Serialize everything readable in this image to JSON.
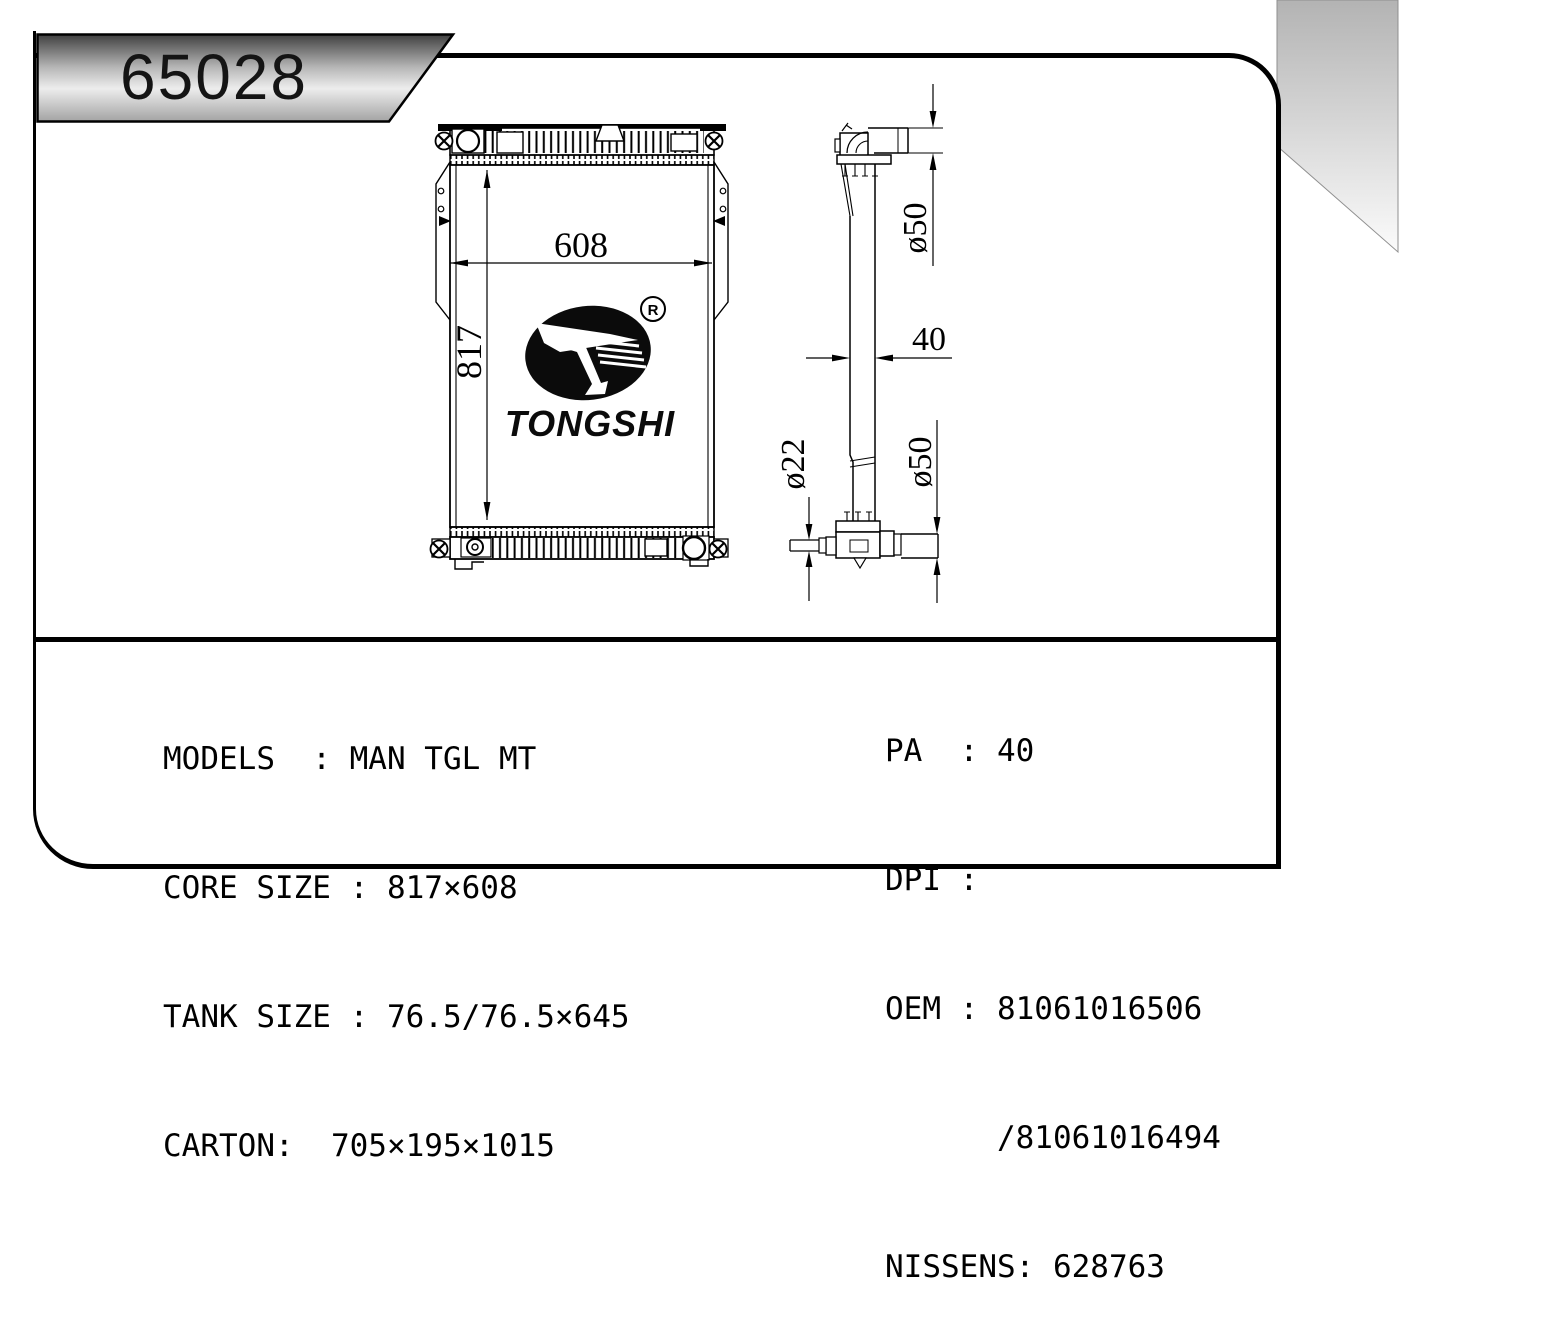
{
  "sheet": {
    "part_number": "65028"
  },
  "logo": {
    "wordmark": "TONGSHI",
    "registered_mark": "R"
  },
  "drawing": {
    "front_view": {
      "width_label": "608",
      "height_label": "817"
    },
    "side_view": {
      "top_pipe_diameter_label": "ø50",
      "thickness_label": "40",
      "bottom_left_pipe_diameter_label": "ø22",
      "bottom_right_pipe_diameter_label": "ø50"
    }
  },
  "specs": {
    "left": [
      {
        "label": "MODELS",
        "value": "MAN TGL MT",
        "line": "MODELS  : MAN TGL MT"
      },
      {
        "label": "CORE SIZE",
        "value": "817×608",
        "line": "CORE SIZE : 817×608"
      },
      {
        "label": "TANK SIZE",
        "value": "76.5/76.5×645",
        "line": "TANK SIZE : 76.5/76.5×645"
      },
      {
        "label": "CARTON",
        "value": "705×195×1015",
        "line": "CARTON:  705×195×1015"
      }
    ],
    "right": [
      {
        "label": "PA",
        "value": "40",
        "line": "PA  : 40"
      },
      {
        "label": "DPI",
        "value": "",
        "line": "DPI :"
      },
      {
        "label": "OEM",
        "value": "81061016506",
        "line": "OEM : 81061016506"
      },
      {
        "label": "",
        "value": "81061016494",
        "line": "      /81061016494"
      },
      {
        "label": "NISSENS",
        "value": "628763",
        "line": "NISSENS: 628763"
      }
    ]
  },
  "colors": {
    "line": "#000000",
    "background": "#ffffff",
    "badge_gradient_top": "#404040",
    "badge_gradient_mid": "#ededed",
    "badge_gradient_bottom": "#a3a3a3",
    "corner_gradient_top": "#b3b3b3",
    "corner_gradient_bottom": "#fbfbfb"
  }
}
